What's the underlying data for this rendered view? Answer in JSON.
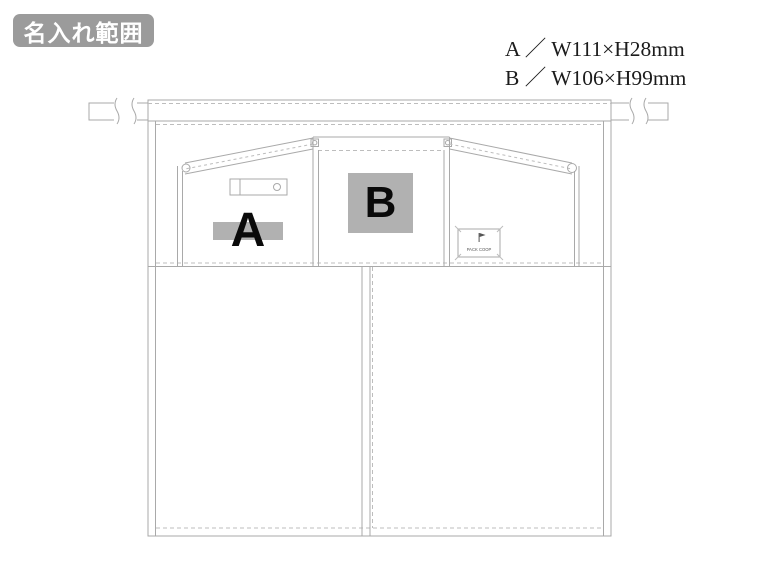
{
  "badge": {
    "text": "名入れ範囲"
  },
  "specs": {
    "a": "A ／ W111×H28mm",
    "b": "B ／ W106×H99mm"
  },
  "print_areas": {
    "a": {
      "label": "A",
      "size": "W111×H28mm"
    },
    "b": {
      "label": "B",
      "size": "W106×H99mm"
    }
  },
  "brand_patch": {
    "icon": "flag-icon",
    "text": "PACK COOP"
  },
  "colors": {
    "line": "#a9a9a9",
    "print_area_fill": "#b1b1b1",
    "badge_background": "#9b9b9b",
    "badge_text": "#ffffff",
    "spec_text": "#1c1c1c"
  }
}
